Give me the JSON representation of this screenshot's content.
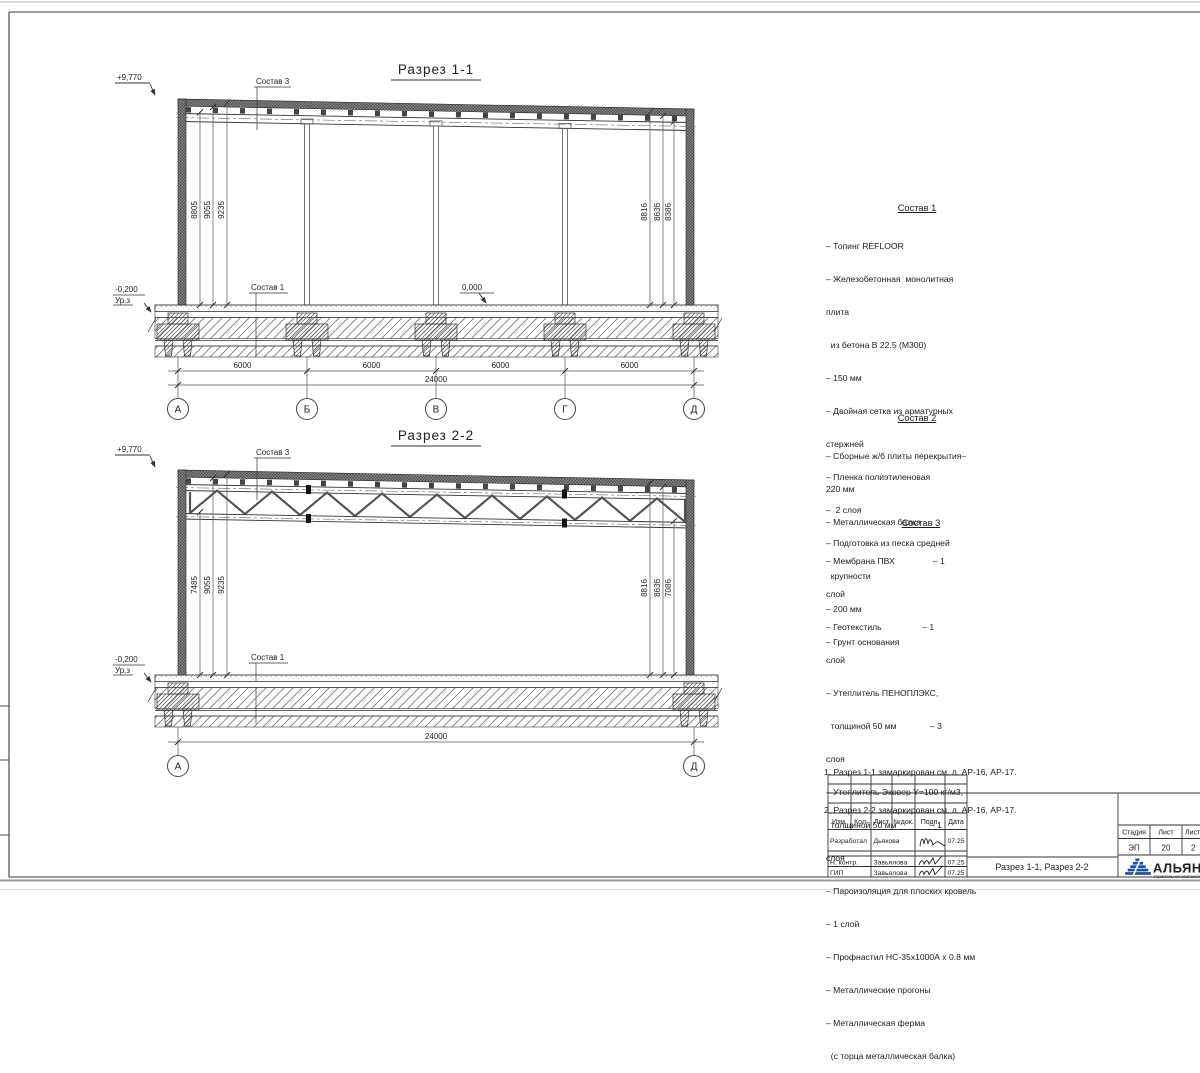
{
  "s1": {
    "title": "Разрез 1-1",
    "elev_top": "+9,770",
    "elev_zero": "0,000",
    "elev_minus": "-0,200",
    "elev_ground": "Ур.з",
    "lbl_sostav3": "Состав 3",
    "lbl_sostav1": "Состав 1",
    "dims_left": [
      "8805",
      "9055",
      "9235"
    ],
    "dims_right": [
      "8816",
      "8636",
      "8386"
    ],
    "dims_span": [
      "6000",
      "6000",
      "6000",
      "6000"
    ],
    "dim_total": "24000",
    "axes": [
      "А",
      "Б",
      "В",
      "Г",
      "Д"
    ]
  },
  "s2": {
    "title": "Разрез 2-2",
    "elev_top": "+9,770",
    "elev_minus": "-0,200",
    "elev_ground": "Ур.з",
    "lbl_sostav3": "Состав 3",
    "lbl_sostav1": "Состав 1",
    "dims_left": [
      "7485",
      "9055",
      "9235"
    ],
    "dims_right": [
      "8816",
      "8636",
      "7086"
    ],
    "dim_total": "24000",
    "axes": [
      "А",
      "Д"
    ]
  },
  "sostav1": {
    "heading": "Состав 1",
    "lines": [
      "– Топинг REFLOOR",
      "– Железобетонная  монолитная",
      "плита",
      "  из бетона В 22.5 (М300)",
      "– 150 мм",
      "– Двойная сетка из арматурных",
      "стержней",
      "– Пленка полиэтиленовая",
      "–  2 слоя",
      "– Подготовка из песка средней",
      "  крупности",
      "– 200 мм",
      "– Грунт основания"
    ]
  },
  "sostav2": {
    "heading": "Состав 2",
    "lines": [
      "– Сборные ж/б плиты перекрытия–",
      "220 мм",
      "– Металлическая балка"
    ]
  },
  "sostav3": {
    "heading": "Состав 3",
    "lines": [
      "– Мембрана ПВХ                – 1",
      "слой",
      "– Геотекстиль                 – 1",
      "слой",
      "– Утеплитель ПЕНОПЛЭКС,",
      "  толщиной 50 мм              – 3",
      "слоя",
      "– Утеплитель Эковер Y=100 кг/м3,",
      "  толщиной 50 мм              – 1",
      "слоя",
      "– Пароизоляция для плоских кровель",
      "– 1 слой",
      "– Профнастил НС-35х1000А х 0.8 мм",
      "– Металлические прогоны",
      "– Металлическая ферма",
      "  (с торца металлическая балка)"
    ]
  },
  "notes": [
    "1. Разрез 1-1 замаркирован см. л. АР-16, АР-17.",
    "2. Разрез 2-2 замаркирован см. л. АР-16, АР-17."
  ],
  "stamp": {
    "cols": [
      "Изм.",
      "Кол.",
      "Лист",
      "№док.",
      "Подп.",
      "Дата"
    ],
    "rows": [
      {
        "role": "Разработал",
        "name": "Дьякова",
        "date": "07.25"
      },
      {
        "role": "Н. контр.",
        "name": "Завьялова",
        "date": "07.25"
      },
      {
        "role": "ГИП",
        "name": "Завьялова",
        "date": "07.25"
      }
    ],
    "doc_title": "Разрез 1-1, Разрез 2-2",
    "stage_label": "Стадия",
    "sheet_label": "Лист",
    "sheets_label": "Листов",
    "stage": "ЭП",
    "sheet": "20",
    "sheets": "2",
    "logo": "АЛЬЯНС",
    "logo_sub": "строительная компания",
    "brand_blue": "#1d4f9e"
  }
}
